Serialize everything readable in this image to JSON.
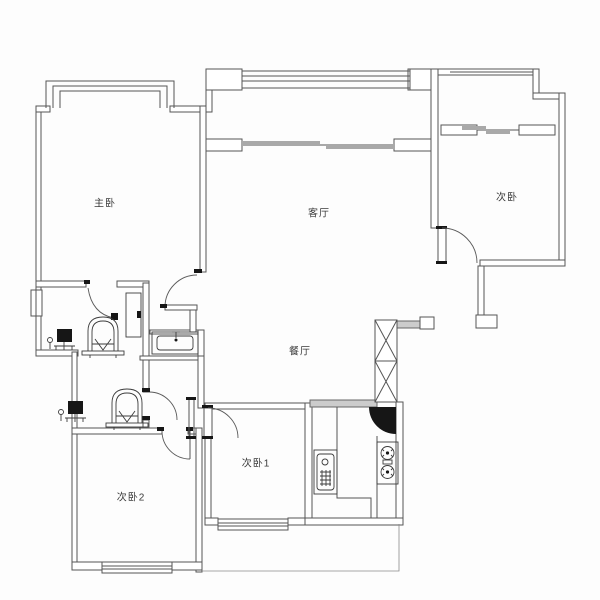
{
  "plan": {
    "type": "apartment-floor-plan",
    "background": "#fdfdfd",
    "wall_color": "#555555",
    "accent_gray": "#a9a9a9",
    "door_fill": "#161616",
    "rooms": [
      {
        "id": "master-bedroom",
        "label": "主卧"
      },
      {
        "id": "living-room",
        "label": "客厅"
      },
      {
        "id": "bedroom-northeast",
        "label": "次卧"
      },
      {
        "id": "dining-room",
        "label": "餐厅"
      },
      {
        "id": "bedroom-1",
        "label": "次卧1"
      },
      {
        "id": "bedroom-2",
        "label": "次卧2"
      }
    ],
    "fixtures": [
      {
        "name": "bay-window",
        "room": "master-bedroom"
      },
      {
        "name": "sliding-window-band",
        "room": "living-room-balcony"
      },
      {
        "name": "balcony-slider",
        "room": "living-room"
      },
      {
        "name": "balcony-slider",
        "room": "bedroom-northeast"
      },
      {
        "name": "toilet",
        "room": "bathroom-1"
      },
      {
        "name": "water-heater",
        "room": "bathroom-1"
      },
      {
        "name": "shower-door-panel",
        "room": "bathroom-1"
      },
      {
        "name": "vanity-sink",
        "room": "hallway"
      },
      {
        "name": "toilet",
        "room": "bathroom-2"
      },
      {
        "name": "water-heater",
        "room": "bathroom-2"
      },
      {
        "name": "kitchen-sink",
        "room": "kitchen"
      },
      {
        "name": "gas-stove",
        "room": "kitchen"
      },
      {
        "name": "vent-shaft",
        "room": "kitchen"
      },
      {
        "name": "entry-door",
        "room": "kitchen"
      },
      {
        "name": "window",
        "room": "bedroom-1"
      },
      {
        "name": "window",
        "room": "bedroom-2"
      },
      {
        "name": "window",
        "room": "bathroom-1"
      }
    ]
  }
}
